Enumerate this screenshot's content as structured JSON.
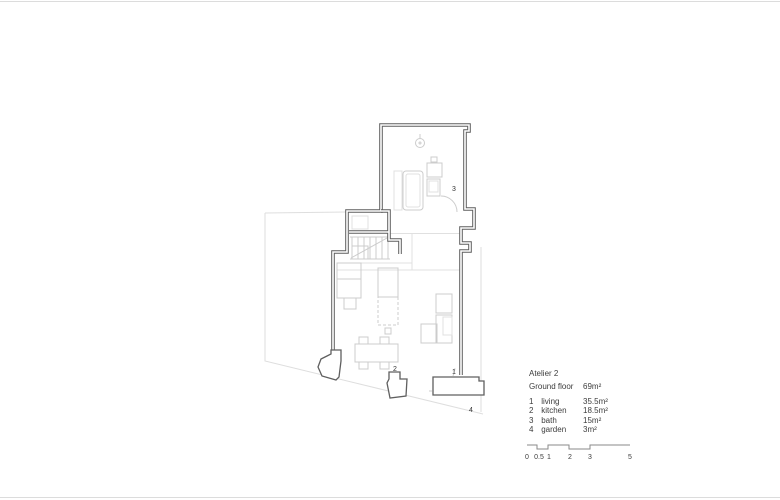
{
  "title": {
    "project": "Atelier 2",
    "floor": "Ground floor",
    "total_area": "69m²"
  },
  "legend_rows": [
    {
      "num": "1",
      "name": "living",
      "area": "35.5m²"
    },
    {
      "num": "2",
      "name": "kitchen",
      "area": "18.5m²"
    },
    {
      "num": "3",
      "name": "bath",
      "area": "15m²"
    },
    {
      "num": "4",
      "name": "garden",
      "area": "3m²"
    }
  ],
  "plan_labels": [
    {
      "text": "1"
    },
    {
      "text": "2"
    },
    {
      "text": "3"
    },
    {
      "text": "4"
    }
  ],
  "scale_bar": {
    "labels": [
      "0",
      "0.5",
      "1",
      "2",
      "3",
      "5"
    ]
  },
  "colors": {
    "wall": "#5f5f5f",
    "furniture": "#cccccc",
    "site_boundary": "#dedede",
    "text": "#3c3c3c"
  }
}
